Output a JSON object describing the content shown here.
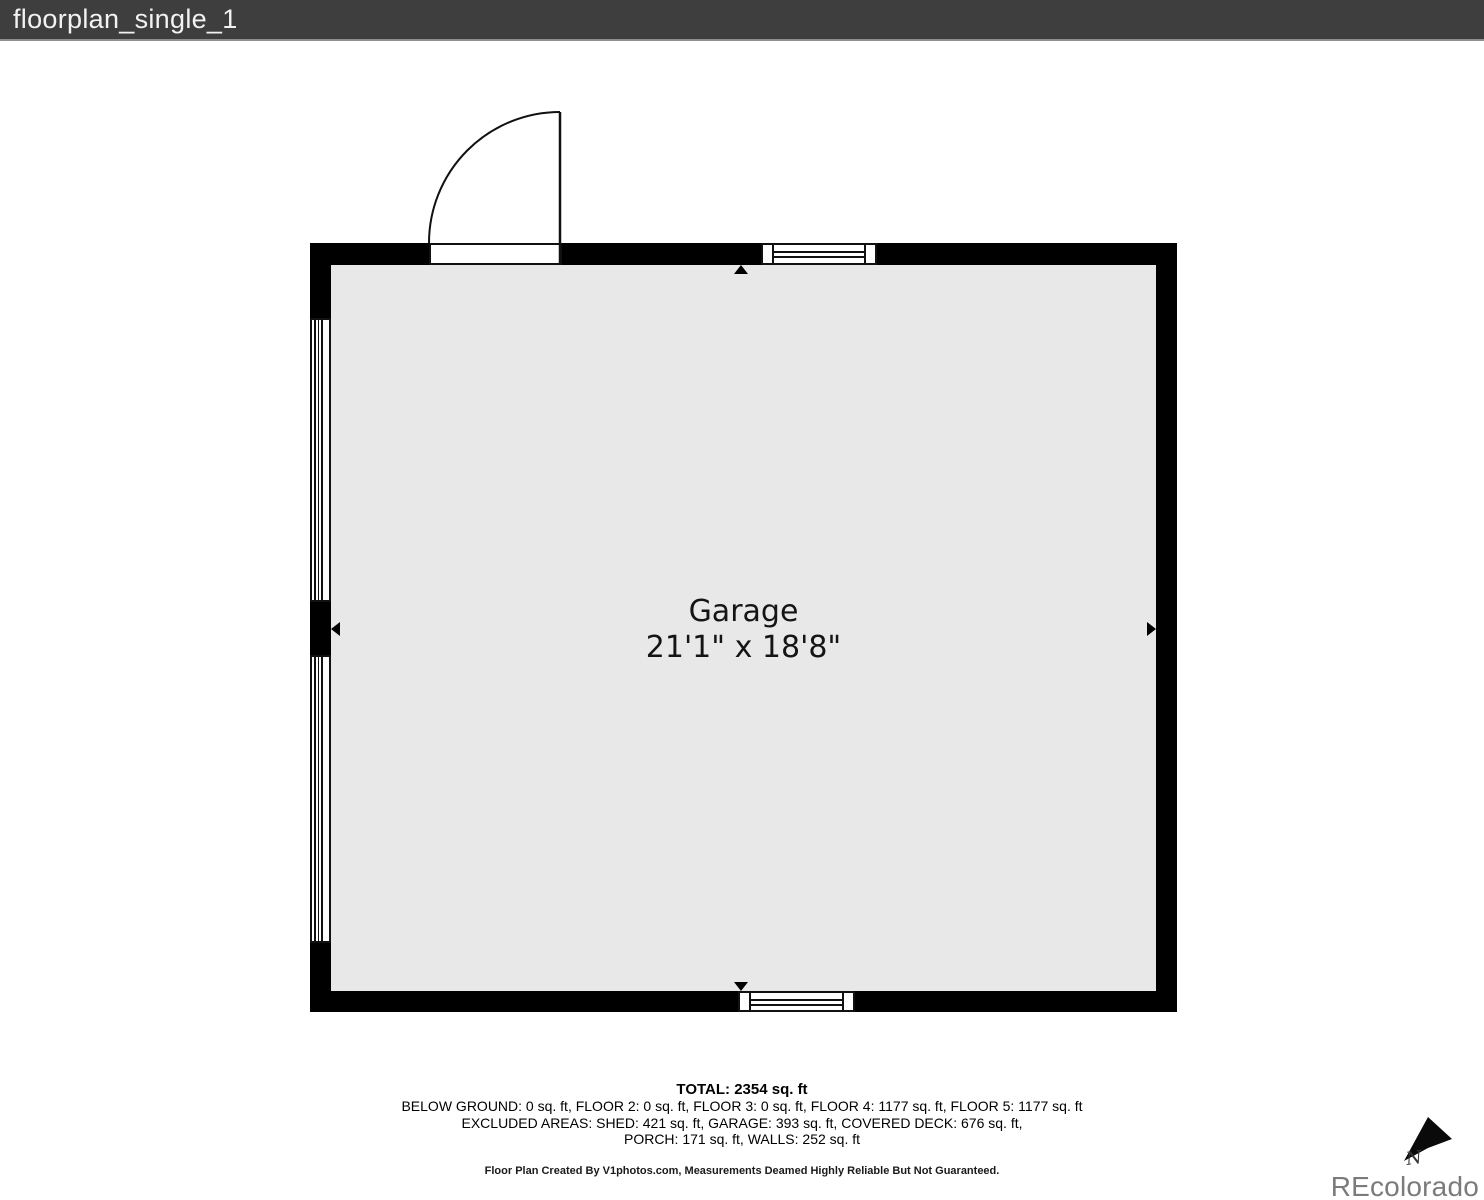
{
  "header": {
    "title": "floorplan_single_1"
  },
  "floorplan": {
    "room": {
      "name": "Garage",
      "dimensions": "21'1\" x 18'8\""
    }
  },
  "summary": {
    "total": "TOTAL: 2354 sq. ft",
    "floors": "BELOW GROUND: 0 sq. ft, FLOOR 2: 0 sq. ft, FLOOR 3: 0 sq. ft, FLOOR 4: 1177 sq. ft, FLOOR 5: 1177 sq. ft",
    "excluded_1": "EXCLUDED AREAS: SHED: 421 sq. ft, GARAGE: 393 sq. ft, COVERED DECK: 676 sq. ft,",
    "excluded_2": "PORCH: 171 sq. ft, WALLS: 252 sq. ft",
    "disclaimer": "Floor Plan Created By V1photos.com, Measurements Deamed Highly Reliable But Not Guaranteed."
  },
  "branding": {
    "logo_text": "REcolorado",
    "north_label": "N"
  },
  "colors": {
    "header_bg": "#3e3e3e",
    "wall": "#000000",
    "room_fill": "#e8e8e8",
    "logo_gray": "#7b7b7b"
  }
}
